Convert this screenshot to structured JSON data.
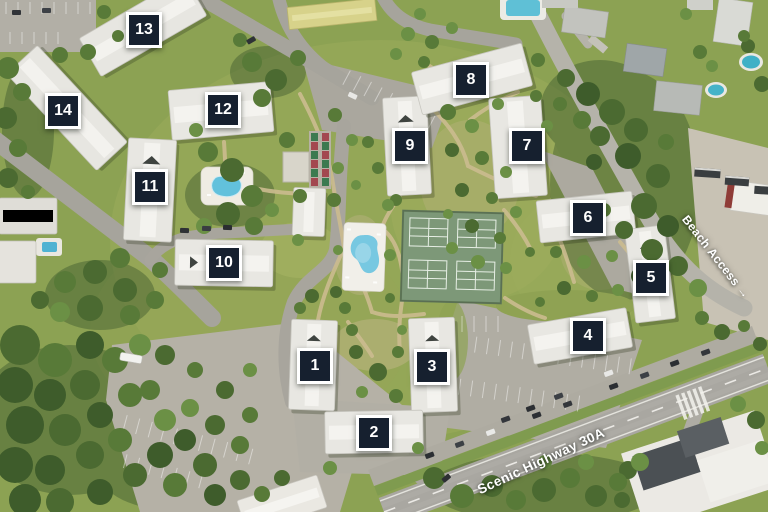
{
  "map": {
    "marker_style": {
      "background": "#16202f",
      "border_color": "#ffffff",
      "text_color": "#ffffff"
    },
    "building_markers": [
      {
        "label": "1",
        "x": 315,
        "y": 366
      },
      {
        "label": "2",
        "x": 374,
        "y": 433
      },
      {
        "label": "3",
        "x": 432,
        "y": 367
      },
      {
        "label": "4",
        "x": 588,
        "y": 336
      },
      {
        "label": "5",
        "x": 651,
        "y": 278
      },
      {
        "label": "6",
        "x": 588,
        "y": 218
      },
      {
        "label": "7",
        "x": 527,
        "y": 146
      },
      {
        "label": "8",
        "x": 471,
        "y": 80
      },
      {
        "label": "9",
        "x": 410,
        "y": 146
      },
      {
        "label": "10",
        "x": 224,
        "y": 263
      },
      {
        "label": "11",
        "x": 150,
        "y": 187
      },
      {
        "label": "12",
        "x": 223,
        "y": 110
      },
      {
        "label": "13",
        "x": 144,
        "y": 30
      },
      {
        "label": "14",
        "x": 63,
        "y": 111
      }
    ],
    "road_labels": [
      {
        "id": "beach-access",
        "text": "Beach Access →",
        "x": 716,
        "y": 257,
        "rotation_deg": 52,
        "font_px": 12
      },
      {
        "id": "scenic-highway-30a",
        "text": "Scenic Highway 30A",
        "x": 541,
        "y": 461,
        "rotation_deg": -25,
        "font_px": 13.5
      }
    ]
  }
}
